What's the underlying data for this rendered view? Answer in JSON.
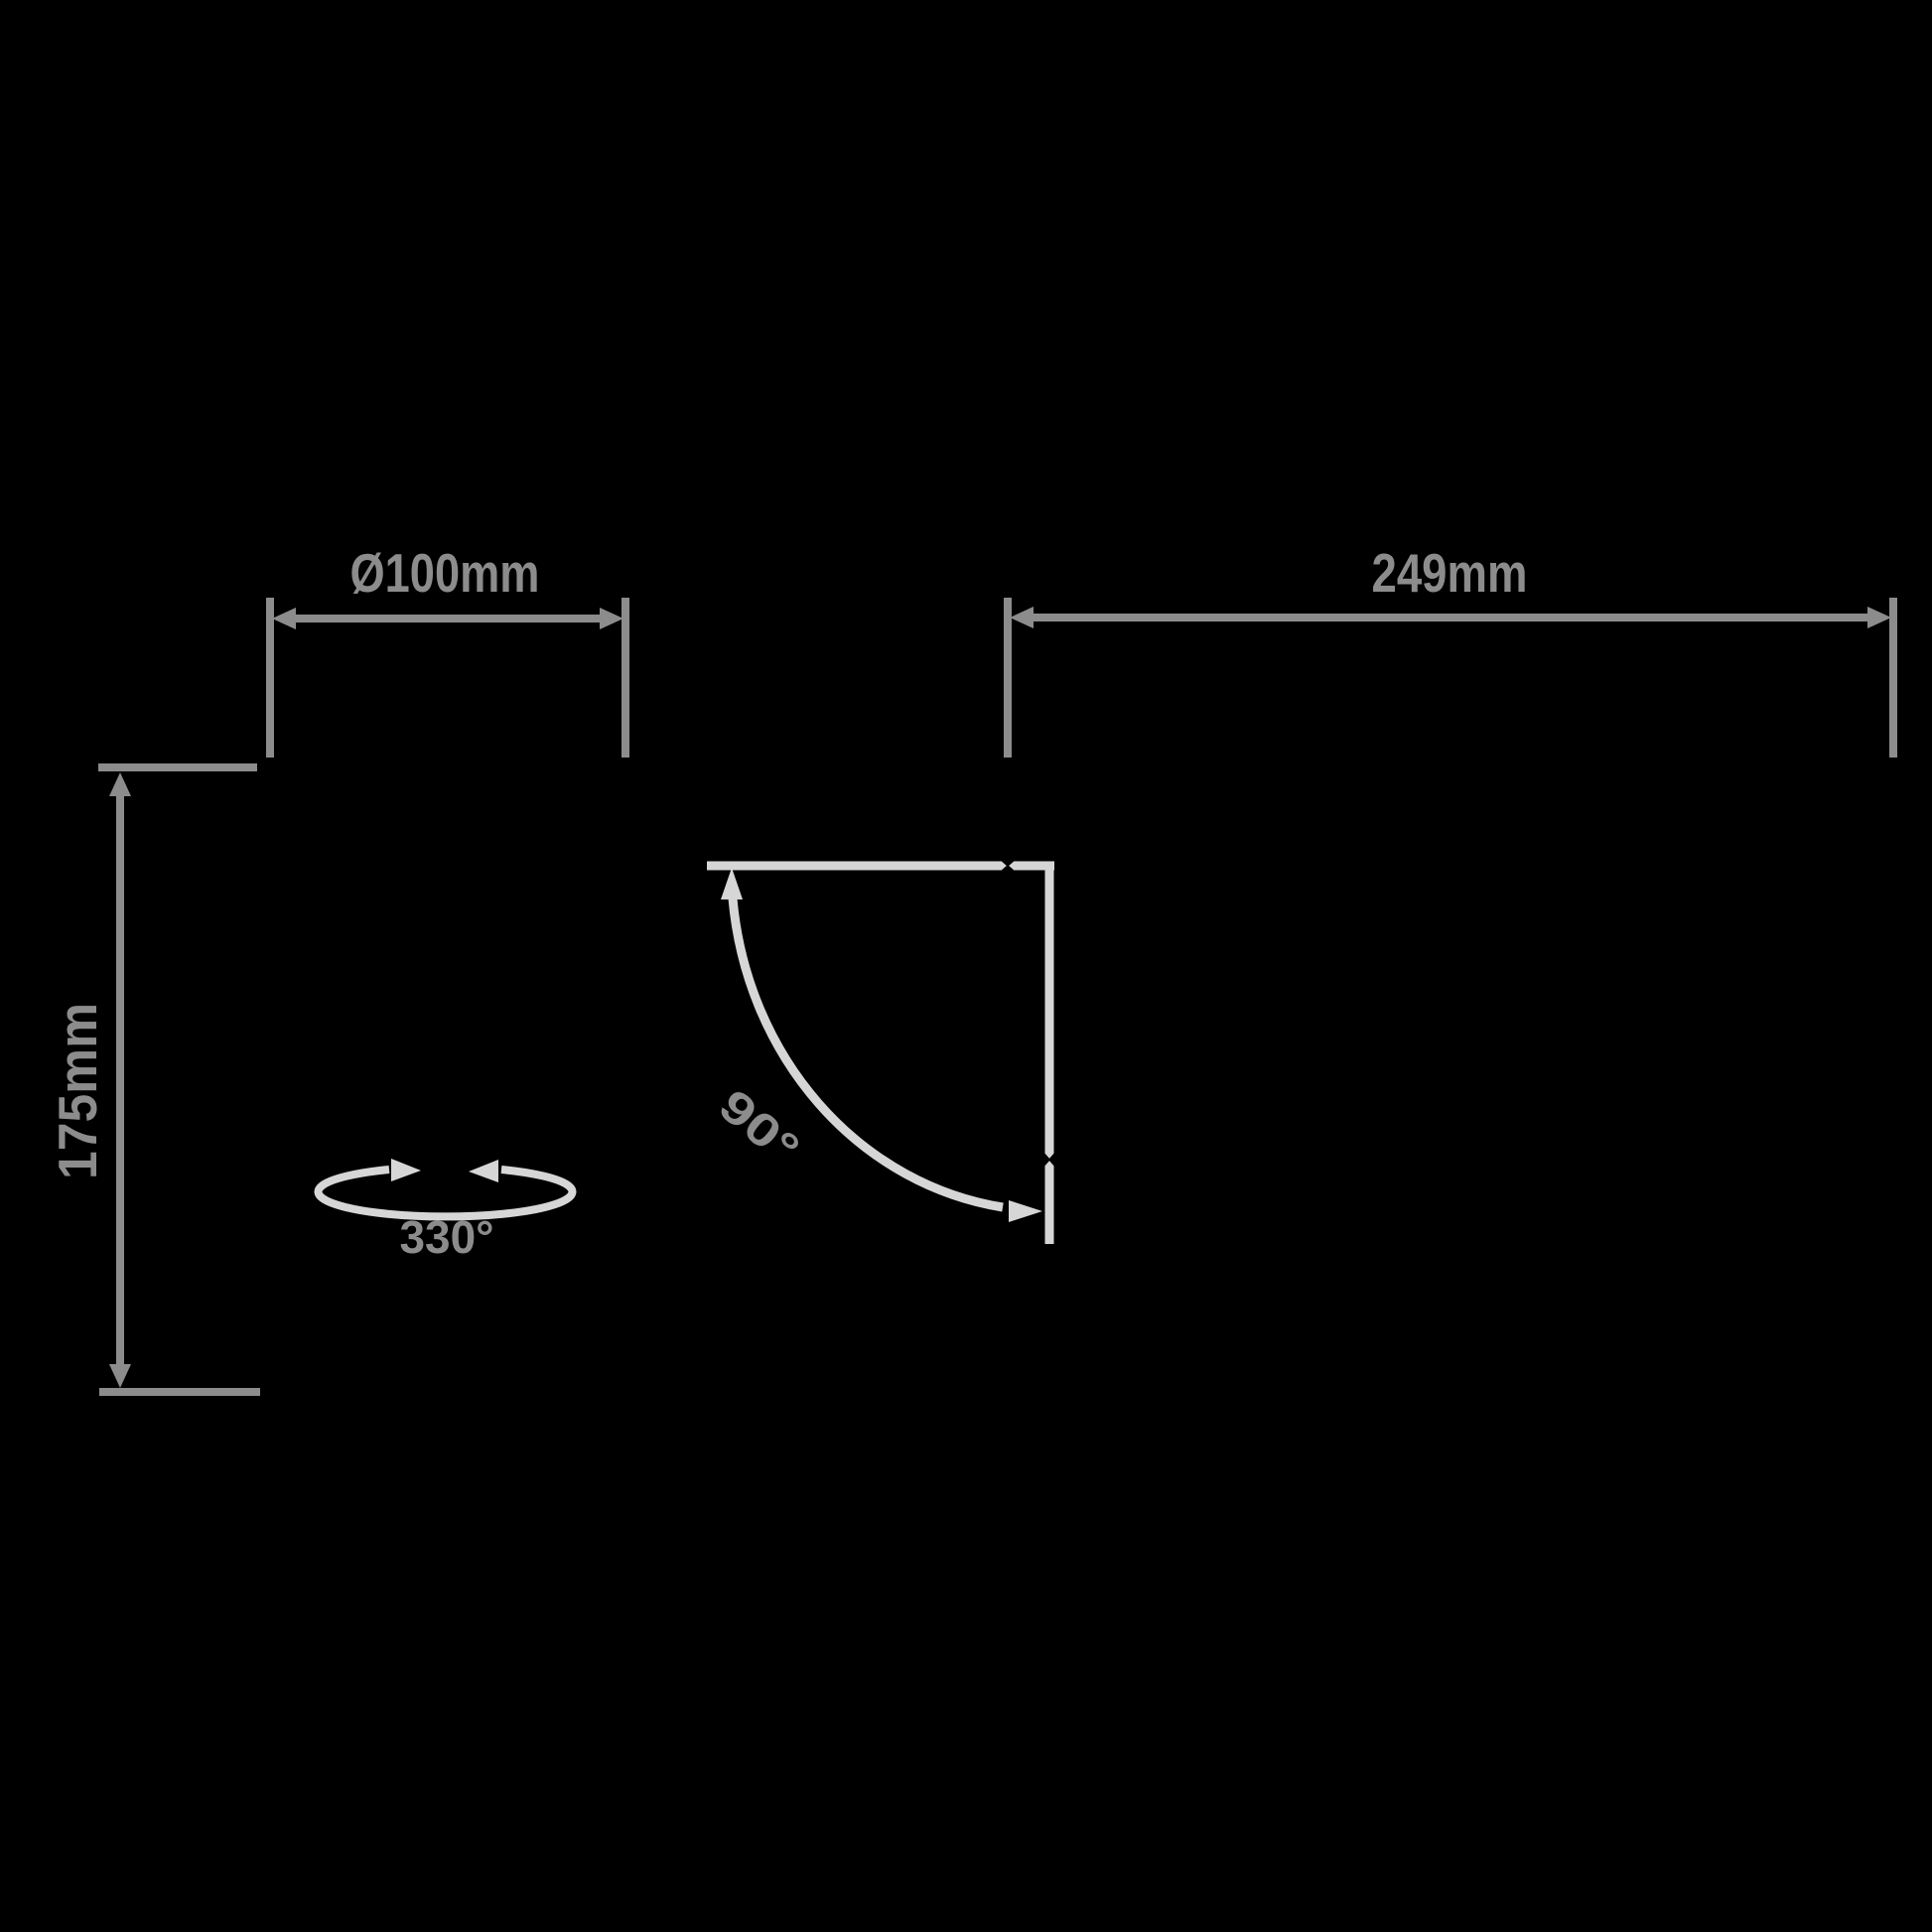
{
  "background": "#000000",
  "colors": {
    "dimension": "#8c8c8c",
    "motion": "#d6d6d6",
    "notch": "#000000"
  },
  "dimensions": {
    "diameter": {
      "label": "Ø100mm"
    },
    "projection": {
      "label": "249mm"
    },
    "height": {
      "label": "175mm"
    }
  },
  "angles": {
    "rotation": {
      "label": "330°"
    },
    "tilt": {
      "label": "90°"
    }
  }
}
